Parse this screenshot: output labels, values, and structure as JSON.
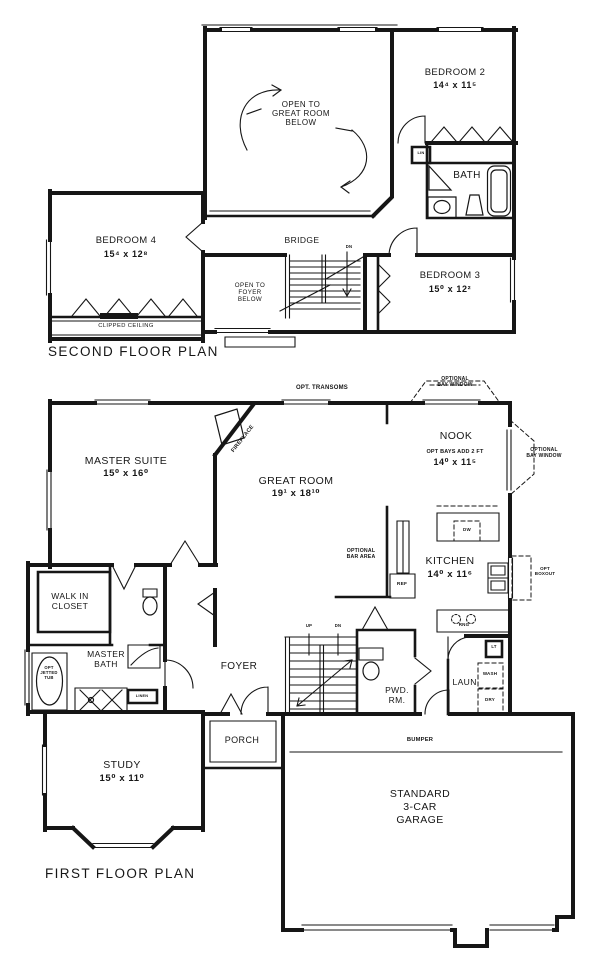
{
  "plan": {
    "ink": "#161616",
    "paper": "#ffffff",
    "second_floor": {
      "title": "SECOND FLOOR PLAN",
      "rooms": {
        "bedroom2": {
          "name": "BEDROOM 2",
          "dims": "14⁴ x 11⁵"
        },
        "bedroom3": {
          "name": "BEDROOM 3",
          "dims": "15⁰ x 12²"
        },
        "bedroom4": {
          "name": "BEDROOM 4",
          "dims": "15⁴ x 12⁸"
        },
        "bath": {
          "name": "BATH"
        }
      },
      "notes": {
        "open_to_great_room": "OPEN TO\nGREAT ROOM\nBELOW",
        "open_to_foyer": "OPEN TO\nFOYER\nBELOW",
        "bridge": "BRIDGE",
        "clipped_ceiling": "CLIPPED CEILING",
        "linen": "LIN",
        "down": "DN"
      }
    },
    "first_floor": {
      "title": "FIRST FLOOR PLAN",
      "rooms": {
        "master_suite": {
          "name": "MASTER SUITE",
          "dims": "15⁰ x 16⁰"
        },
        "great_room": {
          "name": "GREAT ROOM",
          "dims": "19¹ x 18¹⁰"
        },
        "nook": {
          "name": "NOOK",
          "note": "OPT BAYS ADD 2 FT",
          "dims": "14⁰ x 11⁵"
        },
        "kitchen": {
          "name": "KITCHEN",
          "dims": "14⁰ x 11⁶"
        },
        "study": {
          "name": "STUDY",
          "dims": "15⁰ x 11⁰"
        },
        "garage": {
          "name": "STANDARD\n3-CAR\nGARAGE"
        },
        "foyer": {
          "name": "FOYER"
        },
        "porch": {
          "name": "PORCH"
        },
        "walk_in_closet": {
          "name": "WALK IN\nCLOSET"
        },
        "master_bath": {
          "name": "MASTER\nBATH"
        },
        "powder_room": {
          "name": "PWD.\nRM."
        },
        "laundry": {
          "name": "LAUN."
        }
      },
      "notes": {
        "opt_transoms": "OPT. TRANSOMS",
        "optional_bay_window_top": "OPTIONAL\nBAY WINDOW",
        "optional_bay_window_right": "OPTIONAL\nBAY WINDOW",
        "fireplace": "FIREPLACE",
        "optional_bar_area": "OPTIONAL\nBAR AREA",
        "opt_boxout": "OPT\nBOXOUT",
        "opt_jetted_tub": "OPT\nJETTED\nTUB",
        "linen": "LINEN",
        "bumper": "BUMPER",
        "dishwasher": "DW",
        "refrigerator": "REF",
        "range": "RNG",
        "light": "LT",
        "washer": "WASH",
        "dryer": "DRY",
        "up": "UP",
        "down": "DN"
      }
    }
  }
}
